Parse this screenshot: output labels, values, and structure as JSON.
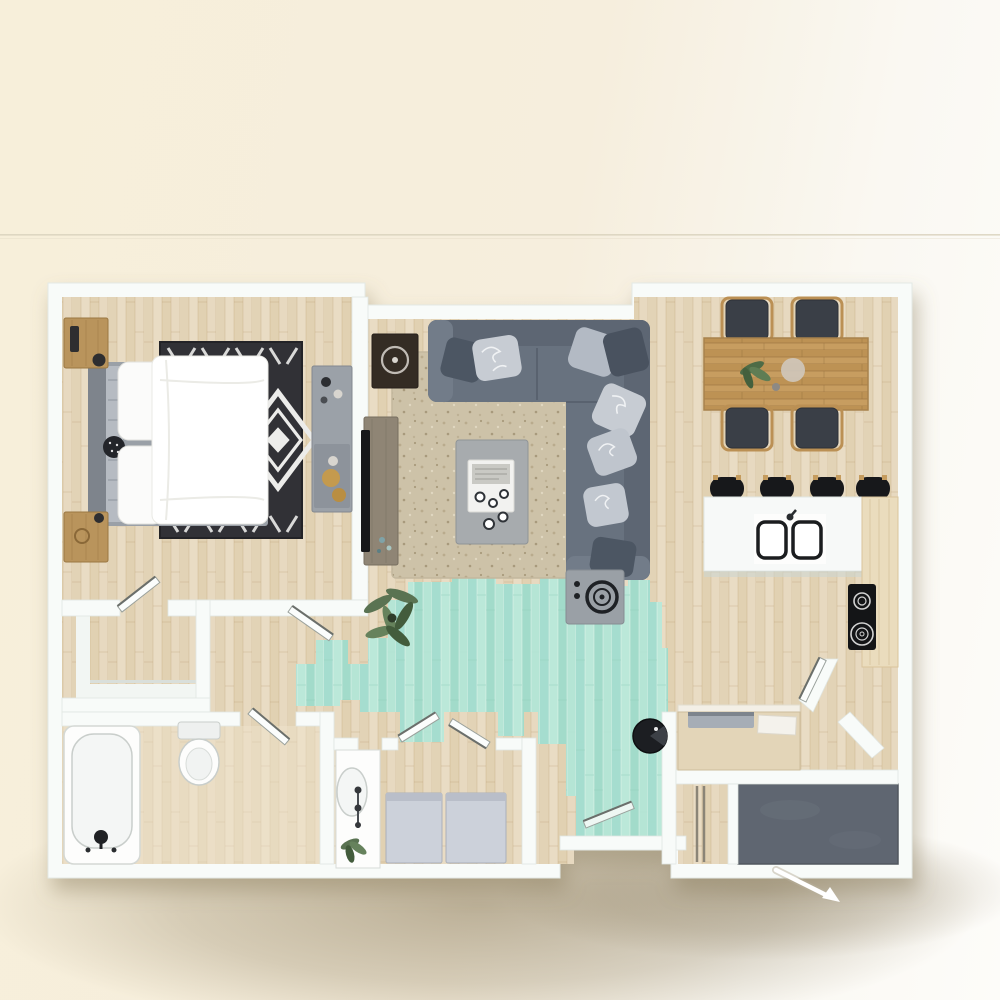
{
  "scene": {
    "kind": "3d-rendered floor plan, top-down view",
    "subject": "one-bedroom apartment",
    "visible_text": "none"
  },
  "background": {
    "left_color": "#f7efda",
    "right_color": "#fdfcf9",
    "divider_line_y": 235,
    "divider_line_color": "#d9d2bd",
    "ground_shadow_color": "#8a7b5c"
  },
  "palette": {
    "wall": "#f8fbf9",
    "wall_edge": "#dde4e0",
    "wood_floor": "#e6d8bf",
    "accent_floor_teal": "#aee4d3",
    "sofa": "#68727f",
    "sofa_back": "#5d6673",
    "pillow_light": "#c7ccd3",
    "pillow_dark": "#4c5663",
    "living_rug": "#cdc2a8",
    "bedroom_rug": "#313136",
    "bedroom_rug_pattern": "#ececea",
    "bed_linen": "#ffffff",
    "headboard": "#7e848c",
    "nightstand_wood": "#b9945c",
    "dresser": "#9ba1a8",
    "tv": "#17181a",
    "console_wood": "#8f8575",
    "coffee_table": "#a7abae",
    "dining_table_wood": "#c79d60",
    "chair_seat": "#3a3f47",
    "chair_frame": "#bb9054",
    "island": "#f7f9f8",
    "counter_wood": "#eadcbd",
    "appliance_black": "#141517",
    "stool": "#17181b",
    "washer_dryer": "#ccd1da",
    "sanitary_white": "#fdfdfc",
    "patio_floor": "#5f6671",
    "desk": "#e3d5b8",
    "laptop": "#a6adb6",
    "plant_green": "#5a7352",
    "door_leaf": "#fbfdfc",
    "arrow": "#ffffff"
  },
  "rooms": [
    {
      "id": "bedroom",
      "contents": [
        "double bed",
        "two nightstands with lamp",
        "black-white diamond rug",
        "dresser with decor"
      ]
    },
    {
      "id": "living-room",
      "contents": [
        "L-shaped sectional sofa with pillows",
        "beige area rug",
        "coffee table with tray",
        "tv console with tv",
        "wall art",
        "potted plant",
        "side table"
      ]
    },
    {
      "id": "dining-area",
      "contents": [
        "wood plank table",
        "four dark chairs",
        "plant centerpiece"
      ]
    },
    {
      "id": "kitchen",
      "contents": [
        "white island with double sink",
        "four bar stools",
        "wood counter",
        "black cooktop with two burners"
      ]
    },
    {
      "id": "hallway",
      "contents": [
        "teal plank accent flooring"
      ]
    },
    {
      "id": "walk-in-closet",
      "contents": [
        "white shelving"
      ]
    },
    {
      "id": "bathroom",
      "contents": [
        "bathtub with faucet",
        "toilet",
        "vanity sink",
        "plant"
      ]
    },
    {
      "id": "laundry-closet",
      "contents": [
        "washer",
        "dryer",
        "bifold doors"
      ]
    },
    {
      "id": "entry",
      "contents": [
        "desk with laptop and paper",
        "round black chair",
        "sliding-door closet"
      ]
    },
    {
      "id": "patio-storage",
      "contents": [
        "dark gray floor"
      ]
    }
  ],
  "annotations": {
    "entry_arrow": "white arrow at bottom-right marking the entrance",
    "doors": [
      "bedroom door",
      "hallway door",
      "bathroom door",
      "laundry bifold doors",
      "kitchen-entry door",
      "corridor end door"
    ]
  }
}
